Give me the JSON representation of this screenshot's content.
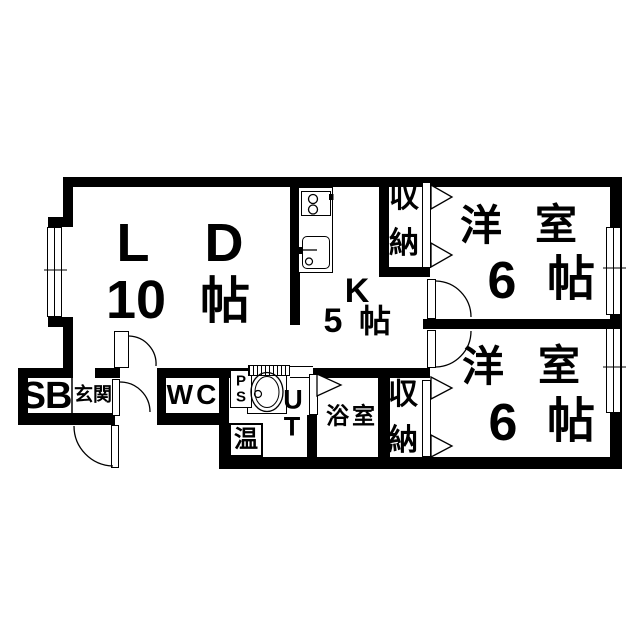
{
  "plan_type": "apartment-floorplan",
  "rooms": {
    "living_dining": {
      "name_chars": [
        "L",
        "D"
      ],
      "size_chars": [
        "10",
        "帖"
      ]
    },
    "kitchen": {
      "label": "K",
      "size_chars": [
        "5",
        "帖"
      ]
    },
    "western_room_1": {
      "name_chars": [
        "洋",
        "室"
      ],
      "size_chars": [
        "6",
        "帖"
      ]
    },
    "western_room_2": {
      "name_chars": [
        "洋",
        "室"
      ],
      "size_chars": [
        "6",
        "帖"
      ]
    },
    "closet_1": {
      "name_chars": [
        "収",
        "納"
      ]
    },
    "closet_2": {
      "name_chars": [
        "収",
        "納"
      ]
    },
    "shoe_box": {
      "label": "SB"
    },
    "entrance": {
      "label": "玄関"
    },
    "toilet": {
      "label": "WC"
    },
    "pipe_space": {
      "name_chars": [
        "P",
        "S"
      ]
    },
    "utility": {
      "name_chars": [
        "U",
        "T"
      ]
    },
    "water_heater": {
      "label": "温"
    },
    "bathroom": {
      "label": "浴室"
    }
  },
  "colors": {
    "wall": "#000000",
    "background": "#ffffff"
  }
}
